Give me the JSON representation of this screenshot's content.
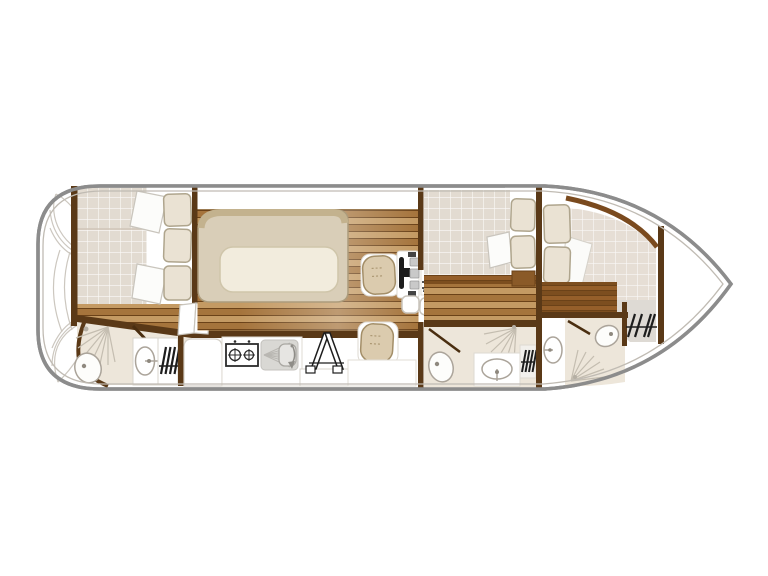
{
  "diagram": {
    "type": "boat-floor-plan",
    "orientation": "bow-right-stern-left",
    "visible_text": "",
    "rooms": [
      {
        "name": "stern-deck",
        "fixtures": [
          "fan-steps-top",
          "fan-steps-bottom",
          "swing-arcs"
        ]
      },
      {
        "name": "aft-cabin",
        "fixtures": [
          "double-bed",
          "pillow-top",
          "pillow-bottom",
          "cushion-column-3",
          "locker-doors"
        ]
      },
      {
        "name": "aft-bathroom",
        "fixtures": [
          "shower-spray",
          "toilet",
          "washbasin",
          "heater-hatch",
          "door"
        ]
      },
      {
        "name": "salon",
        "fixtures": [
          "l-bench",
          "table",
          "swivel-chair-front",
          "swivel-chair-rear",
          "helm-console",
          "steering-wheel",
          "companionway-hatch",
          "step-pads"
        ]
      },
      {
        "name": "galley",
        "fixtures": [
          "fridge-cabinet",
          "two-burner-stove",
          "sink-with-drainer",
          "folding-steps",
          "counter"
        ]
      },
      {
        "name": "mid-cabin",
        "fixtures": [
          "double-bed",
          "pillow",
          "cushion-pair",
          "cabinet"
        ]
      },
      {
        "name": "mid-bathroom",
        "fixtures": [
          "toilet",
          "shower-spray",
          "washbasin",
          "heater-hatch",
          "door"
        ]
      },
      {
        "name": "corridor",
        "fixtures": [
          "washbasin"
        ]
      },
      {
        "name": "bow-cabin",
        "fixtures": [
          "double-bed",
          "cushion-pair",
          "sheet",
          "curved-wall"
        ]
      },
      {
        "name": "bow-bathroom",
        "fixtures": [
          "toilet",
          "shower-spray",
          "door"
        ]
      },
      {
        "name": "bow-utility",
        "fixtures": [
          "heater-hatch"
        ]
      },
      {
        "name": "foredeck",
        "fixtures": []
      }
    ]
  },
  "colors": {
    "hull_stroke": "#8C8C8C",
    "inner_line": "#C0BBB3",
    "wall": "#5A3917",
    "wall_light": "#7A4A1E",
    "plank_a": "#A5743C",
    "plank_b": "#C49A63",
    "plank_line": "#6B4218",
    "plank_deep_a": "#7C4E1F",
    "plank_deep_b": "#955F2A",
    "mattress": "#E2DBD1",
    "mattress2": "#E6DED5",
    "bench": "#D9CEB8",
    "bench_band": "#C3B28E",
    "bench_edge": "#AC9C7C",
    "table": "#F2ECDD",
    "table_edge": "#CFC5AA",
    "cushion": "#EAE2D3",
    "cushion_edge": "#AFA58D",
    "chair": "#DBCBAE",
    "chair_edge": "#A38E68",
    "bath_floor": "#EDE6DA",
    "gray_zone": "#DEDAD4",
    "sink_gray": "#D9D8D4",
    "fixture_edge": "#ABA49A",
    "spray": "#C4BDB0",
    "door": "#4A2E10",
    "black": "#1D1D1D",
    "white": "#FFFFFF"
  }
}
